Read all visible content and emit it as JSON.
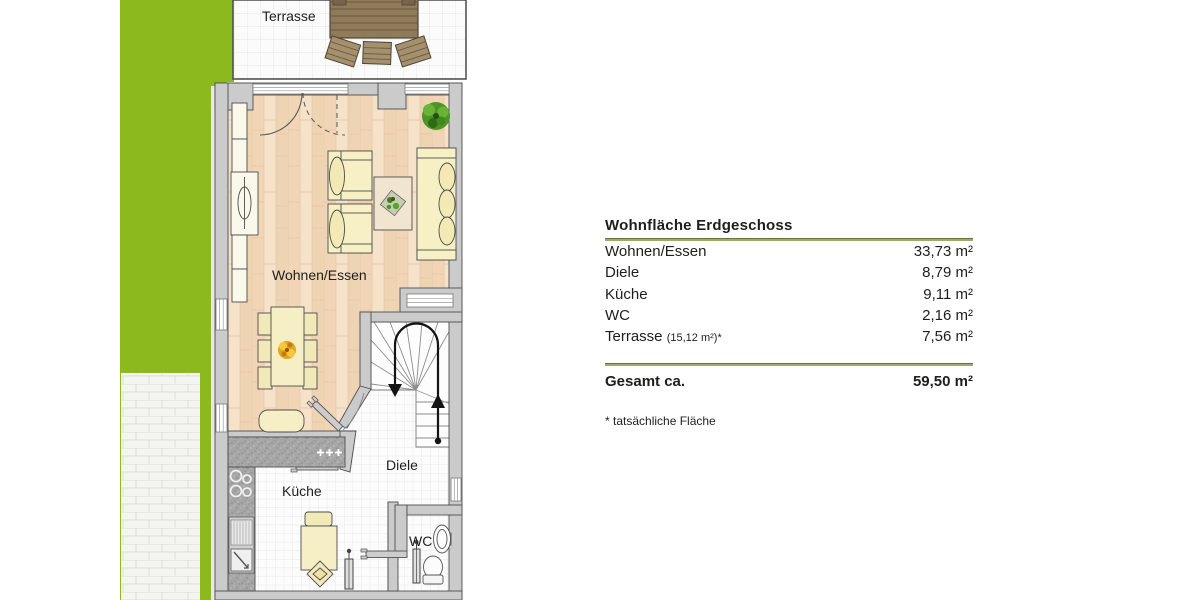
{
  "plan": {
    "room_labels": {
      "terrasse": "Terrasse",
      "wohnen_essen": "Wohnen/Essen",
      "diele": "Diele",
      "kueche": "Küche",
      "wc": "WC"
    }
  },
  "legend": {
    "title": "Wohnfläche Erdgeschoss",
    "rows": [
      {
        "label": "Wohnen/Essen",
        "value": "33,73 m²"
      },
      {
        "label": "Diele",
        "value": "8,79 m²"
      },
      {
        "label": "Küche",
        "value": "9,11 m²"
      },
      {
        "label": "WC",
        "value": "2,16 m²"
      },
      {
        "label": "Terrasse",
        "note": "(15,12 m²)*",
        "value": "7,56 m²"
      }
    ],
    "total": {
      "label": "Gesamt ca.",
      "value": "59,50 m²"
    },
    "footnote": "* tatsächliche Fläche"
  },
  "colors": {
    "lawn_green": "#8CBA1E",
    "rule_green": "#9DAC6B",
    "wall_gray": "#CBCBCB",
    "wood_floor": "#F3DBC1",
    "furniture_cream": "#F7F0C5",
    "terrace_wood": "#8F7A59"
  }
}
